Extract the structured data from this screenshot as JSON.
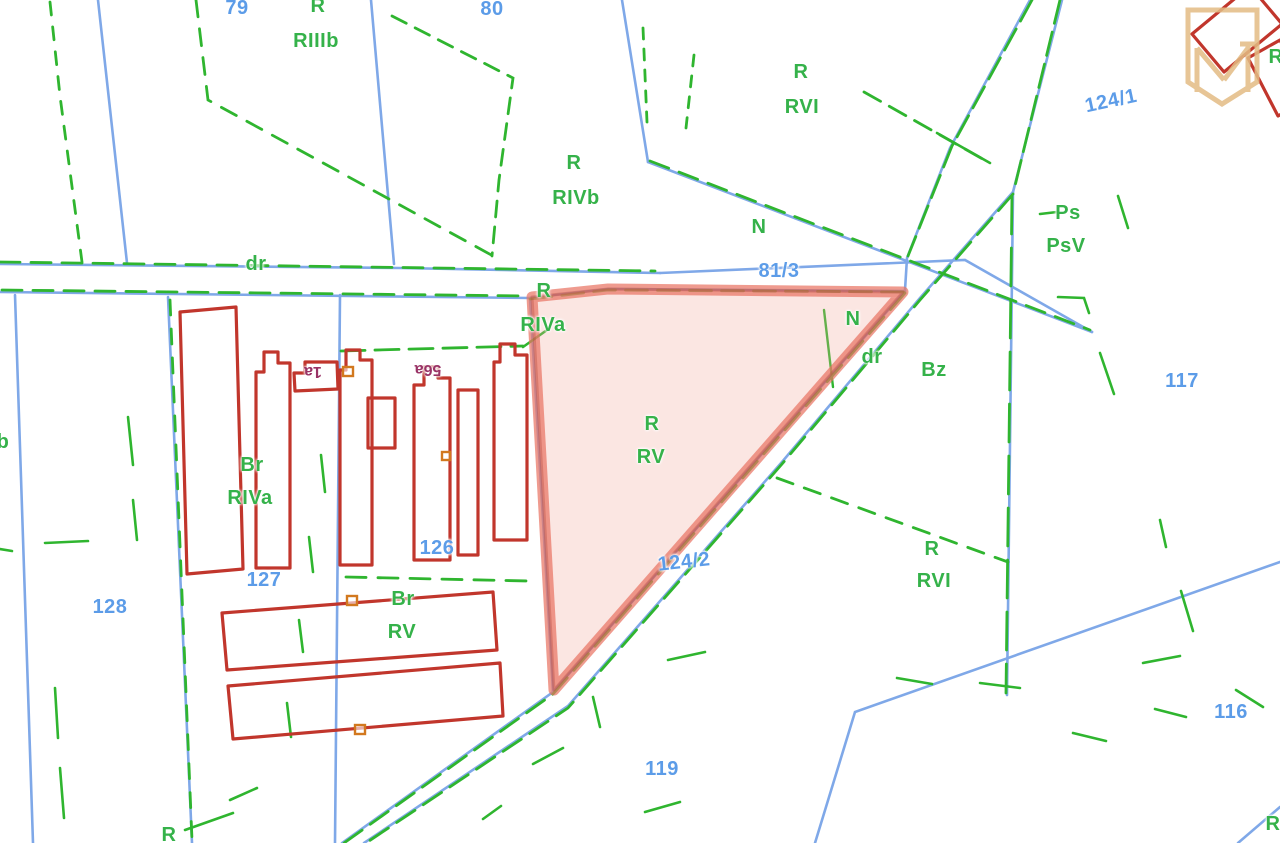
{
  "map": {
    "background": "#FFFFFF",
    "colors": {
      "parcel_boundary": "#7FA8E8",
      "parcel_number_text": "#5C9CE8",
      "landuse_boundary": "#2FB52F",
      "landuse_text": "#35B24A",
      "building_outline": "#C1362C",
      "highlight_stroke": "#E97464",
      "highlight_fill": "#F6AC9F",
      "address_text": "#993366",
      "address_marker": "#D2781E",
      "watermark": "#E3BC84"
    },
    "label_groups": [
      {
        "group": "parcel-numbers",
        "css": "blue",
        "items": [
          {
            "name": "parcel-label-79",
            "text": "79",
            "x": 237,
            "y": 8
          },
          {
            "name": "parcel-label-80",
            "text": "80",
            "x": 492,
            "y": 9
          },
          {
            "name": "parcel-label-81-3",
            "text": "81/3",
            "x": 779,
            "y": 271
          },
          {
            "name": "parcel-label-124-1",
            "text": "124/1",
            "x": 1111,
            "y": 101,
            "rot": -12
          },
          {
            "name": "parcel-label-117",
            "text": "117",
            "x": 1182,
            "y": 381
          },
          {
            "name": "parcel-label-126",
            "text": "126",
            "x": 437,
            "y": 548
          },
          {
            "name": "parcel-label-127",
            "text": "127",
            "x": 264,
            "y": 580
          },
          {
            "name": "parcel-label-128",
            "text": "128",
            "x": 110,
            "y": 607
          },
          {
            "name": "parcel-label-124-2",
            "text": "124/2",
            "x": 684,
            "y": 562,
            "rot": -6
          },
          {
            "name": "parcel-label-119",
            "text": "119",
            "x": 662,
            "y": 769
          },
          {
            "name": "parcel-label-116",
            "text": "116",
            "x": 1231,
            "y": 712
          }
        ]
      },
      {
        "group": "landuse-codes",
        "css": "green",
        "items": [
          {
            "name": "landuse-R-riiib",
            "text": "R",
            "x": 318,
            "y": 6
          },
          {
            "name": "landuse-RIIIb",
            "text": "RIIIb",
            "x": 316,
            "y": 41
          },
          {
            "name": "landuse-R-rivb",
            "text": "R",
            "x": 574,
            "y": 163
          },
          {
            "name": "landuse-RIVb",
            "text": "RIVb",
            "x": 576,
            "y": 198
          },
          {
            "name": "landuse-R-rvi-top",
            "text": "R",
            "x": 801,
            "y": 72
          },
          {
            "name": "landuse-RVI-top",
            "text": "RVI",
            "x": 802,
            "y": 107
          },
          {
            "name": "landuse-N-top",
            "text": "N",
            "x": 759,
            "y": 227
          },
          {
            "name": "landuse-dr-west",
            "text": "dr",
            "x": 256,
            "y": 264
          },
          {
            "name": "landuse-R-riva-parcel",
            "text": "R",
            "x": 544,
            "y": 291
          },
          {
            "name": "landuse-RIVa-parcel",
            "text": "RIVa",
            "x": 543,
            "y": 325
          },
          {
            "name": "landuse-N-parcel",
            "text": "N",
            "x": 853,
            "y": 319
          },
          {
            "name": "landuse-dr-south",
            "text": "dr",
            "x": 872,
            "y": 357
          },
          {
            "name": "landuse-Bz",
            "text": "Bz",
            "x": 934,
            "y": 370
          },
          {
            "name": "landuse-R-rv-parcel",
            "text": "R",
            "x": 652,
            "y": 424
          },
          {
            "name": "landuse-RV-parcel",
            "text": "RV",
            "x": 651,
            "y": 457
          },
          {
            "name": "landuse-Br-west",
            "text": "Br",
            "x": 252,
            "y": 465
          },
          {
            "name": "landuse-RIVa-west",
            "text": "RIVa",
            "x": 250,
            "y": 498
          },
          {
            "name": "landuse-Br-south",
            "text": "Br",
            "x": 403,
            "y": 599
          },
          {
            "name": "landuse-RV-south",
            "text": "RV",
            "x": 402,
            "y": 632
          },
          {
            "name": "landuse-Ps",
            "text": "Ps",
            "x": 1068,
            "y": 213
          },
          {
            "name": "landuse-PsV",
            "text": "PsV",
            "x": 1066,
            "y": 246
          },
          {
            "name": "landuse-R-rvi-se",
            "text": "R",
            "x": 932,
            "y": 549
          },
          {
            "name": "landuse-RVI-se",
            "text": "RVI",
            "x": 934,
            "y": 581
          },
          {
            "name": "landuse-R-bottom-left",
            "text": "R",
            "x": 169,
            "y": 835
          },
          {
            "name": "landuse-RI-bottom-right",
            "text": "RI",
            "x": 1276,
            "y": 824
          },
          {
            "name": "landuse-b-left-edge",
            "text": "b",
            "x": 3,
            "y": 442
          },
          {
            "name": "landuse-R-top-right",
            "text": "R",
            "x": 1276,
            "y": 57
          }
        ]
      },
      {
        "group": "address-numbers",
        "css": "magenta",
        "items": [
          {
            "name": "address-label-1a",
            "text": "1a",
            "x": 313,
            "y": 371,
            "rot": 180
          },
          {
            "name": "address-label-56a",
            "text": "56a",
            "x": 428,
            "y": 369,
            "rot": 180
          }
        ]
      }
    ]
  }
}
